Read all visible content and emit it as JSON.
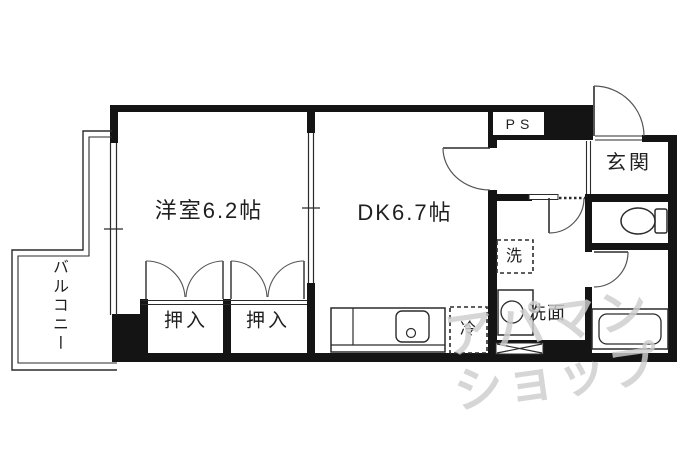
{
  "floorplan": {
    "rooms": {
      "western_room": "洋室6.2帖",
      "dining_kitchen": "DK6.7帖",
      "balcony": "バルコニー",
      "closet_left": "押入",
      "closet_right": "押入",
      "entrance": "玄関",
      "pipe_space": "PS",
      "washing_machine": "洗",
      "washstand": "洗面",
      "refrigerator": "冷"
    },
    "watermark": {
      "line1": "アパマン",
      "line2": "ショップ",
      "color": "#cecece"
    },
    "colors": {
      "wall": "#141414",
      "thin_line": "#2b2b2b",
      "door_arc": "#555555",
      "background": "#ffffff"
    }
  }
}
